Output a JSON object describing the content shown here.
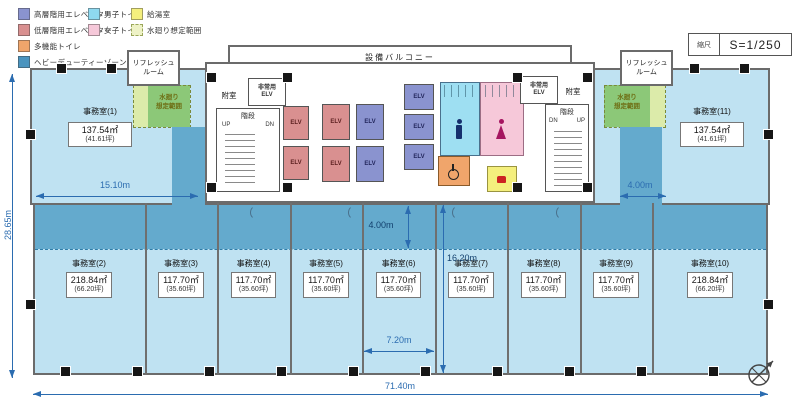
{
  "legend": {
    "items": [
      {
        "label": "高層階用エレベーター",
        "color": "#8a93cf",
        "swatch": "solid"
      },
      {
        "label": "低層階用エレベーター",
        "color": "#d99090",
        "swatch": "solid"
      },
      {
        "label": "多機能トイレ",
        "color": "#f0a56b",
        "swatch": "solid"
      },
      {
        "label": "ヘビーデューティーゾーン",
        "color": "#4a94bf",
        "swatch": "solid"
      },
      {
        "label": "男子トイレ",
        "color": "#8ed9f0",
        "swatch": "solid"
      },
      {
        "label": "女子トイレ",
        "color": "#f6c8d9",
        "swatch": "solid"
      },
      {
        "label": "給湯室",
        "color": "#f4ef7d",
        "swatch": "solid"
      },
      {
        "label": "水廻り想定範囲",
        "color": "#eef2c6",
        "swatch": "dashed"
      }
    ]
  },
  "scale": {
    "label": "縮尺",
    "value": "S=1/250"
  },
  "core": {
    "balcony": "設備バルコニー",
    "anteroom": "附室",
    "stairs": "階段",
    "up": "UP",
    "dn": "DN",
    "elv": "ELV",
    "emergency_line1": "非常用",
    "emergency_line2": "ELV"
  },
  "rooms": {
    "refresh_line1": "リフレッシュ",
    "refresh_line2": "ルーム",
    "water_line1": "水廻り",
    "water_line2": "想定範囲"
  },
  "offices": [
    {
      "name": "事務室(1)",
      "area": "137.54㎡",
      "tsubo": "(41.61坪)"
    },
    {
      "name": "事務室(2)",
      "area": "218.84㎡",
      "tsubo": "(66.20坪)"
    },
    {
      "name": "事務室(3)",
      "area": "117.70㎡",
      "tsubo": "(35.60坪)"
    },
    {
      "name": "事務室(4)",
      "area": "117.70㎡",
      "tsubo": "(35.60坪)"
    },
    {
      "name": "事務室(5)",
      "area": "117.70㎡",
      "tsubo": "(35.60坪)"
    },
    {
      "name": "事務室(6)",
      "area": "117.70㎡",
      "tsubo": "(35.60坪)"
    },
    {
      "name": "事務室(7)",
      "area": "117.70㎡",
      "tsubo": "(35.60坪)"
    },
    {
      "name": "事務室(8)",
      "area": "117.70㎡",
      "tsubo": "(35.60坪)"
    },
    {
      "name": "事務室(9)",
      "area": "117.70㎡",
      "tsubo": "(35.60坪)"
    },
    {
      "name": "事務室(10)",
      "area": "218.84㎡",
      "tsubo": "(66.20坪)"
    },
    {
      "name": "事務室(11)",
      "area": "137.54㎡",
      "tsubo": "(41.61坪)"
    }
  ],
  "dimensions": {
    "total_width": "71.40m",
    "total_height": "28.65m",
    "wing_left": "15.10m",
    "wing_right": "4.00m",
    "band_depth": "4.00m",
    "office_depth": "16.20m",
    "bay_width": "7.20m"
  },
  "colors": {
    "office_fill": "#bfe2f2",
    "heavy_duty_zone": "#64aacd",
    "water_zone_green": "#8cc878",
    "water_zone_light": "#dcebaa",
    "dimension_blue": "#2b6cb0"
  }
}
